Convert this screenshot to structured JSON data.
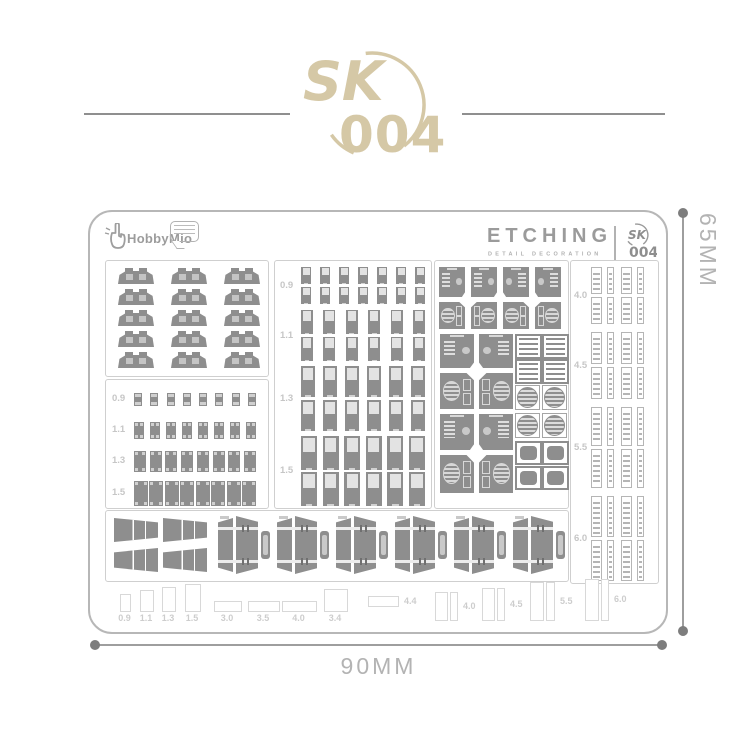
{
  "colors": {
    "accent_tan": "#d5c8a6",
    "part_gray": "#8e8e8e",
    "divider_gray": "#8f8f8f"
  },
  "header": {
    "logo_sk": "SK",
    "logo_number": "004"
  },
  "sheet": {
    "brand": {
      "name": "HobbyMio"
    },
    "etch": {
      "title": "ETCHING",
      "subtitle": "DETAIL DECORATION",
      "badge_sk": "SK",
      "badge_number": "004"
    },
    "clips_box": {
      "rows": 5,
      "cols": 3
    },
    "left_box": {
      "rows": [
        {
          "label": "0.9",
          "count": 8,
          "pw": 8,
          "ph": 13
        },
        {
          "label": "1.1",
          "count": 8,
          "pw": 10,
          "ph": 17
        },
        {
          "label": "1.3",
          "count": 8,
          "pw": 12,
          "ph": 21
        },
        {
          "label": "1.5",
          "count": 8,
          "pw": 14,
          "ph": 25
        }
      ]
    },
    "middle_box": {
      "groups": [
        {
          "label": "0.9",
          "cols": 7,
          "pw": 10,
          "ph": 17,
          "y1": 6,
          "y2": 26
        },
        {
          "label": "1.1",
          "cols": 6,
          "pw": 12,
          "ph": 24,
          "y1": 49,
          "y2": 76
        },
        {
          "label": "1.3",
          "cols": 6,
          "pw": 14,
          "ph": 31,
          "y1": 105,
          "y2": 139
        },
        {
          "label": "1.5",
          "cols": 6,
          "pw": 16,
          "ph": 34,
          "y1": 175,
          "y2": 211
        }
      ]
    },
    "panels_box": {
      "items": [
        {
          "t": "vent",
          "x": 4,
          "y": 6,
          "w": 26,
          "h": 30
        },
        {
          "t": "vent",
          "x": 36,
          "y": 6,
          "w": 26,
          "h": 30
        },
        {
          "t": "vent",
          "x": 68,
          "y": 6,
          "w": 26,
          "h": 30,
          "f": 1
        },
        {
          "t": "vent",
          "x": 100,
          "y": 6,
          "w": 26,
          "h": 30,
          "f": 1
        },
        {
          "t": "disk",
          "x": 4,
          "y": 41,
          "w": 26,
          "h": 27
        },
        {
          "t": "disk",
          "x": 36,
          "y": 41,
          "w": 26,
          "h": 27,
          "f": 1
        },
        {
          "t": "disk",
          "x": 68,
          "y": 41,
          "w": 26,
          "h": 27
        },
        {
          "t": "disk",
          "x": 100,
          "y": 41,
          "w": 26,
          "h": 27,
          "f": 1
        },
        {
          "t": "vent",
          "x": 5,
          "y": 73,
          "w": 34,
          "h": 34
        },
        {
          "t": "vent",
          "x": 44,
          "y": 73,
          "w": 34,
          "h": 34,
          "f": 1
        },
        {
          "t": "slat",
          "x": 80,
          "y": 73,
          "w": 23,
          "h": 21
        },
        {
          "t": "slat",
          "x": 107,
          "y": 73,
          "w": 23,
          "h": 21
        },
        {
          "t": "slat",
          "x": 80,
          "y": 98,
          "w": 23,
          "h": 21
        },
        {
          "t": "slat",
          "x": 107,
          "y": 98,
          "w": 23,
          "h": 21
        },
        {
          "t": "disk",
          "x": 5,
          "y": 112,
          "w": 34,
          "h": 36
        },
        {
          "t": "disk",
          "x": 44,
          "y": 112,
          "w": 34,
          "h": 36,
          "f": 1
        },
        {
          "t": "grille",
          "x": 80,
          "y": 124,
          "w": 23,
          "h": 23
        },
        {
          "t": "grille",
          "x": 107,
          "y": 124,
          "w": 23,
          "h": 23
        },
        {
          "t": "vent",
          "x": 5,
          "y": 153,
          "w": 34,
          "h": 36
        },
        {
          "t": "vent",
          "x": 44,
          "y": 153,
          "w": 34,
          "h": 36,
          "f": 1
        },
        {
          "t": "grille",
          "x": 80,
          "y": 152,
          "w": 23,
          "h": 23
        },
        {
          "t": "grille",
          "x": 107,
          "y": 152,
          "w": 23,
          "h": 23
        },
        {
          "t": "hatch",
          "x": 80,
          "y": 180,
          "w": 23,
          "h": 20
        },
        {
          "t": "hatch",
          "x": 107,
          "y": 180,
          "w": 23,
          "h": 20
        },
        {
          "t": "disk",
          "x": 5,
          "y": 194,
          "w": 34,
          "h": 38
        },
        {
          "t": "disk",
          "x": 44,
          "y": 194,
          "w": 34,
          "h": 38,
          "f": 1
        },
        {
          "t": "hatch",
          "x": 80,
          "y": 205,
          "w": 23,
          "h": 20
        },
        {
          "t": "hatch",
          "x": 107,
          "y": 205,
          "w": 23,
          "h": 20
        }
      ]
    },
    "strips_box": {
      "cols": [
        {
          "x": 20,
          "w": 11
        },
        {
          "x": 36,
          "w": 7
        },
        {
          "x": 50,
          "w": 11
        },
        {
          "x": 66,
          "w": 7
        }
      ],
      "groups": [
        {
          "label": "4.0",
          "y1": 6,
          "y2": 36,
          "h": 27
        },
        {
          "label": "4.5",
          "y1": 71,
          "y2": 106,
          "h": 32
        },
        {
          "label": "5.5",
          "y1": 146,
          "y2": 188,
          "h": 39
        },
        {
          "label": "6.0",
          "y1": 235,
          "y2": 279,
          "h": 41
        }
      ]
    },
    "bottom_box": {
      "trap_count": 4,
      "clamp_count": 6
    },
    "ruler": {
      "items": [
        {
          "k": "v",
          "label": "0.9",
          "x": 30,
          "w": 9,
          "h": 16
        },
        {
          "k": "v",
          "label": "1.1",
          "x": 50,
          "w": 12,
          "h": 20
        },
        {
          "k": "v",
          "label": "1.3",
          "x": 72,
          "w": 12,
          "h": 23
        },
        {
          "k": "v",
          "label": "1.5",
          "x": 95,
          "w": 14,
          "h": 26
        },
        {
          "k": "h",
          "label": "3.0",
          "x": 124,
          "w": 26,
          "h": 9
        },
        {
          "k": "h",
          "label": "3.5",
          "x": 158,
          "w": 30,
          "h": 9
        },
        {
          "k": "h",
          "label": "4.0",
          "x": 192,
          "w": 33,
          "h": 9
        },
        {
          "k": "sq",
          "label": "3.4",
          "x": 234,
          "w": 22,
          "h": 21
        },
        {
          "k": "hr",
          "label": "4.4",
          "x": 278,
          "w": 29,
          "h": 9
        },
        {
          "k": "pair",
          "label": "4.0",
          "x": 345,
          "w": 11,
          "w2": 6,
          "h": 27
        },
        {
          "k": "pair",
          "label": "4.5",
          "x": 392,
          "w": 11,
          "w2": 6,
          "h": 31
        },
        {
          "k": "pair",
          "label": "5.5",
          "x": 440,
          "w": 12,
          "w2": 7,
          "h": 37
        },
        {
          "k": "pair",
          "label": "6.0",
          "x": 495,
          "w": 12,
          "w2": 6,
          "h": 40
        }
      ]
    }
  },
  "dims": {
    "width_label": "90MM",
    "height_label": "65MM"
  }
}
